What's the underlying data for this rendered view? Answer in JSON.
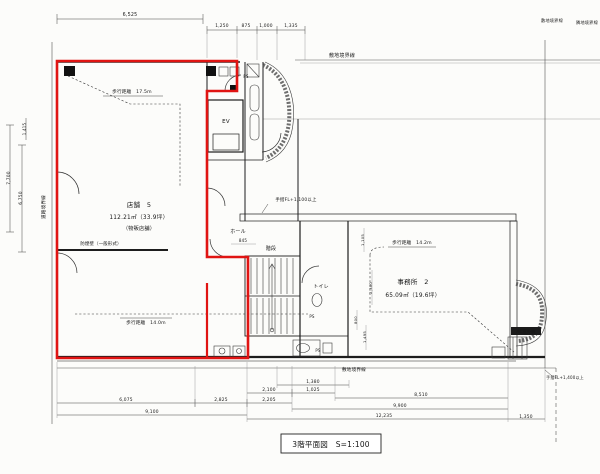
{
  "meta": {
    "drawing_type": "architectural floor plan (scanned)",
    "floor": "3階",
    "scale": "S=1:100"
  },
  "caption": {
    "text": "3階平面図　S=1:100"
  },
  "colors": {
    "highlight_outline": "#e01412",
    "line": "#1d1d1d",
    "paper": "#fcfcfa"
  },
  "rooms": {
    "store5": {
      "name": "店舗　5",
      "area": "112.21㎡（33.9坪）",
      "use": "（物販店舗）"
    },
    "office2": {
      "name": "事務所　2",
      "area": "65.09㎡（19.6坪）"
    },
    "elevator": "EV",
    "hall": "ホール",
    "stairs": "階段",
    "toilet": "トイレ",
    "pipe_space": "PS"
  },
  "labels": [
    {
      "name": "dim-top-6525",
      "text": "6,525",
      "x": 130,
      "y": 16,
      "size": 4.8
    },
    {
      "name": "dim-top-1250",
      "text": "1,250",
      "x": 222,
      "y": 27,
      "size": 4.4
    },
    {
      "name": "dim-top-875",
      "text": "875",
      "x": 246,
      "y": 27,
      "size": 4.4
    },
    {
      "name": "dim-top-1000",
      "text": "1,000",
      "x": 266,
      "y": 27,
      "size": 4.4
    },
    {
      "name": "dim-top-1335",
      "text": "1,335",
      "x": 291,
      "y": 27,
      "size": 4.4
    },
    {
      "name": "boundary-label-top",
      "text": "敷地境界線",
      "x": 342,
      "y": 57,
      "size": 5
    },
    {
      "name": "boundary-label-topright-1",
      "text": "敷地境界線",
      "x": 552,
      "y": 22,
      "size": 4.2
    },
    {
      "name": "boundary-label-topright-2",
      "text": "隣地境界線",
      "x": 587,
      "y": 24,
      "size": 4.2
    },
    {
      "name": "boundary-label-left",
      "text": "道路境界線",
      "x": 45,
      "y": 207,
      "size": 4.6,
      "rot": -90
    },
    {
      "name": "dim-left-1415",
      "text": "1,415",
      "x": 26,
      "y": 129,
      "size": 4,
      "rot": -90
    },
    {
      "name": "dim-left-7700",
      "text": "7,700",
      "x": 10,
      "y": 178,
      "size": 4.4,
      "rot": -90
    },
    {
      "name": "dim-left-6750",
      "text": "6,750",
      "x": 22,
      "y": 198,
      "size": 4.4,
      "rot": -90
    },
    {
      "name": "walk-distance-store-top",
      "text": "歩行距離　17.5m",
      "x": 132,
      "y": 93,
      "size": 4.6
    },
    {
      "name": "store5-name",
      "text": "店舗　5",
      "x": 139,
      "y": 207,
      "size": 6.5
    },
    {
      "name": "store5-area",
      "text": "112.21㎡（33.9坪）",
      "x": 139,
      "y": 219,
      "size": 5.8
    },
    {
      "name": "store5-use",
      "text": "（物販店舗）",
      "x": 139,
      "y": 230,
      "size": 5.2
    },
    {
      "name": "smoke-barrier-note",
      "text": "防煙壁（一般形式）",
      "x": 101,
      "y": 245,
      "size": 4.4
    },
    {
      "name": "walk-distance-store-bottom",
      "text": "歩行距離　14.0m",
      "x": 146,
      "y": 324,
      "size": 4.6
    },
    {
      "name": "hall-label",
      "text": "ホール",
      "x": 238,
      "y": 233,
      "size": 5
    },
    {
      "name": "dim-hall-845",
      "text": "845",
      "x": 243,
      "y": 242,
      "size": 4
    },
    {
      "name": "ev-label",
      "text": "EV",
      "x": 226,
      "y": 123,
      "size": 5.5
    },
    {
      "name": "ps-label-top",
      "text": "PS",
      "x": 246,
      "y": 78,
      "size": 4
    },
    {
      "name": "handrail-note-mid",
      "text": "手摺FL+1,100以上",
      "x": 296,
      "y": 201,
      "size": 4.4
    },
    {
      "name": "stairs-label",
      "text": "階段",
      "x": 271,
      "y": 250,
      "size": 5
    },
    {
      "name": "toilet-label",
      "text": "トイレ",
      "x": 321,
      "y": 288,
      "size": 5
    },
    {
      "name": "ps-label-mid",
      "text": "PS",
      "x": 312,
      "y": 318,
      "size": 4
    },
    {
      "name": "ps-label-low",
      "text": "PS",
      "x": 318,
      "y": 352,
      "size": 4
    },
    {
      "name": "walk-distance-office",
      "text": "歩行距離　14.2m",
      "x": 412,
      "y": 244,
      "size": 4.6
    },
    {
      "name": "office2-name",
      "text": "事務所　2",
      "x": 413,
      "y": 284,
      "size": 6.5
    },
    {
      "name": "office2-area",
      "text": "65.09㎡（19.6坪）",
      "x": 413,
      "y": 297,
      "size": 5.8
    },
    {
      "name": "ac-unit-label",
      "text": "AC室外機",
      "x": 526,
      "y": 333,
      "size": 4.2,
      "fill": "#ffffff"
    },
    {
      "name": "handrail-note-bottomright",
      "text": "手摺FL+1,400以上",
      "x": 565,
      "y": 379,
      "size": 4
    },
    {
      "name": "boundary-label-bottom",
      "text": "敷地境界線",
      "x": 354,
      "y": 371,
      "size": 4.6
    },
    {
      "name": "dim-bot-1380",
      "text": "1,380",
      "x": 313,
      "y": 383,
      "size": 4.4
    },
    {
      "name": "dim-bot-2100",
      "text": "2,100",
      "x": 269,
      "y": 391,
      "size": 4.4
    },
    {
      "name": "dim-bot-1025",
      "text": "1,025",
      "x": 313,
      "y": 391,
      "size": 4.4
    },
    {
      "name": "dim-bot-8510",
      "text": "8,510",
      "x": 421,
      "y": 396,
      "size": 4.4
    },
    {
      "name": "dim-bot-6075",
      "text": "6,075",
      "x": 126,
      "y": 401,
      "size": 4.4
    },
    {
      "name": "dim-bot-2825",
      "text": "2,825",
      "x": 221,
      "y": 401,
      "size": 4.4
    },
    {
      "name": "dim-bot-2205",
      "text": "2,205",
      "x": 269,
      "y": 401,
      "size": 4.4
    },
    {
      "name": "dim-bot-9900",
      "text": "9,900",
      "x": 400,
      "y": 407,
      "size": 4.4
    },
    {
      "name": "dim-bot-9100",
      "text": "9,100",
      "x": 152,
      "y": 413,
      "size": 4.4
    },
    {
      "name": "dim-bot-12235",
      "text": "12,235",
      "x": 384,
      "y": 417,
      "size": 4.4
    },
    {
      "name": "dim-bot-1350",
      "text": "1,350",
      "x": 526,
      "y": 418,
      "size": 4.4
    },
    {
      "name": "dim-int-1105",
      "text": "1,105",
      "x": 364,
      "y": 240,
      "size": 3.8,
      "rot": -90
    },
    {
      "name": "dim-int-2300",
      "text": "2,300",
      "x": 372,
      "y": 288,
      "size": 3.8,
      "rot": -90
    },
    {
      "name": "dim-int-800",
      "text": "800",
      "x": 357,
      "y": 320,
      "size": 3.8,
      "rot": -90
    },
    {
      "name": "dim-int-1495",
      "text": "1,495",
      "x": 366,
      "y": 337,
      "size": 3.8,
      "rot": -90
    }
  ]
}
